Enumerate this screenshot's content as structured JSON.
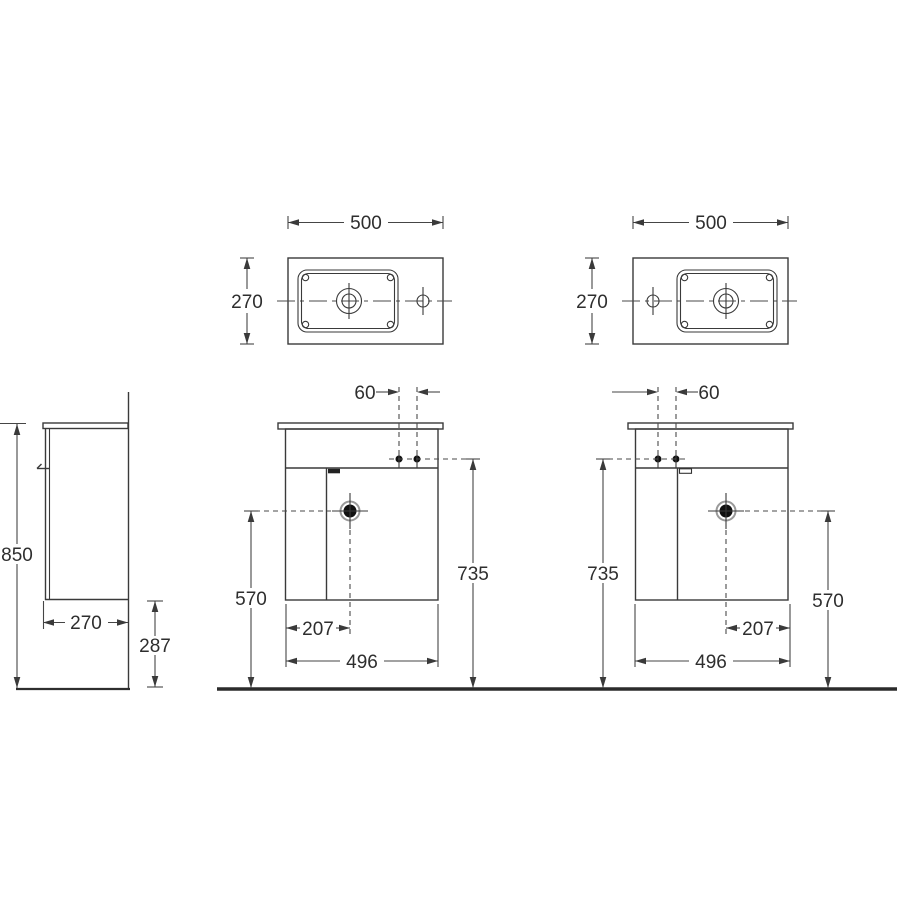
{
  "drawing": {
    "type": "technical-drawing",
    "subject": "wall-hung cloakroom vanity unit with basin, left-hand and right-hand versions",
    "background": "#ffffff",
    "line_color": "#3a3a3a",
    "views": {
      "top_left": {
        "width": "500",
        "depth": "270"
      },
      "top_right": {
        "width": "500",
        "depth": "270"
      },
      "side": {
        "overall_height": "850",
        "depth": "270",
        "floor_clearance": "287"
      },
      "front_left": {
        "tap_spacing": "60",
        "tap_height": "735",
        "drain_height": "570",
        "drain_offset": "207",
        "cabinet_width": "496"
      },
      "front_right": {
        "tap_spacing": "60",
        "tap_height": "735",
        "drain_height": "570",
        "drain_offset": "207",
        "cabinet_width": "496"
      }
    }
  }
}
